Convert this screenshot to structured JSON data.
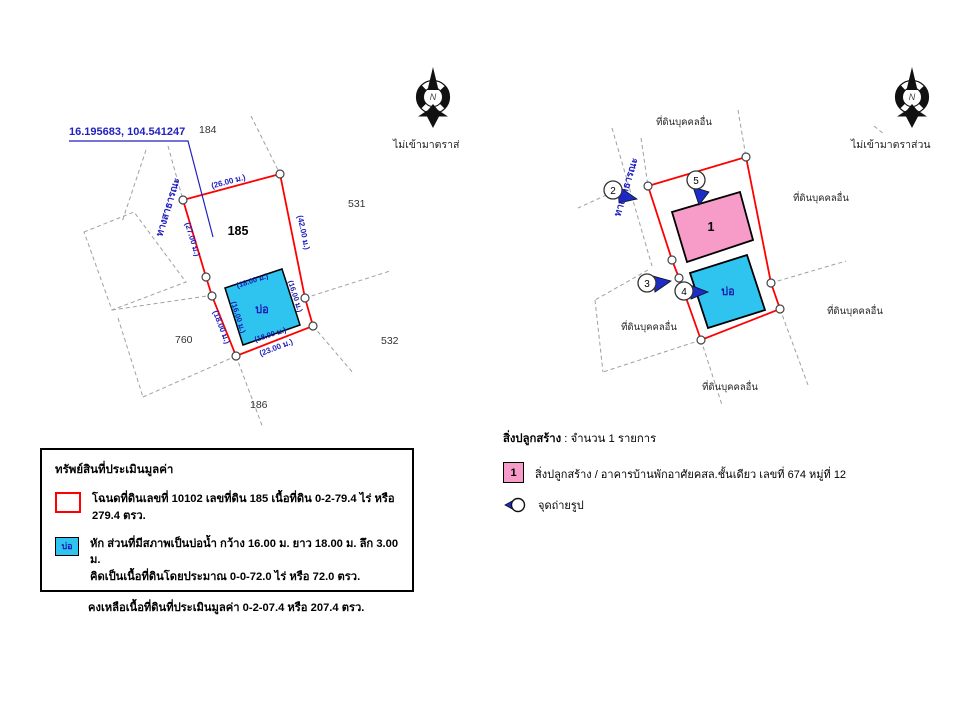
{
  "colors": {
    "boundary_red": "#ff0000",
    "label_blue": "#2222c0",
    "pond_cyan": "#2ec4ef",
    "building_pink": "#f79bc8",
    "dash_gray": "#a0a0a0"
  },
  "left_diagram": {
    "coords": "16.195683, 104.541247",
    "plot_number": "185",
    "neighbors": {
      "top": "184",
      "right_upper": "531",
      "right_lower": "532",
      "left": "760",
      "bottom": "186"
    },
    "road": "ทางสาธารณะ",
    "north": "N",
    "not_to_scale": "ไม่เข้ามาตราส่",
    "dims": {
      "top": "(26.00 ม.)",
      "right": "(42.00 ม.)",
      "left_upper": "(27.00 ม.)",
      "left_lower": "(18.00 ม.)",
      "bottom": "(23.00 ม.)"
    },
    "pond": {
      "label": "บ่อ",
      "top": "(18.00 ม.)",
      "right": "(16.00 ม.)",
      "bottom": "(18.00 ม.)",
      "left": "(16.00 ม.)"
    }
  },
  "right_diagram": {
    "road": "ทางสาธารณะ",
    "north": "N",
    "not_to_scale": "ไม่เข้ามาตราส่วน",
    "neighbor": "ที่ดินบุคคลอื่น",
    "building_label": "1",
    "pond_label": "บ่อ",
    "markers": [
      "2",
      "3",
      "4",
      "5"
    ]
  },
  "property_legend": {
    "title": "ทรัพย์สินที่ประเมินมูลค่า",
    "deed_line": "โฉนดที่ดินเลขที่ 10102 เลขที่ดิน 185 เนื้อที่ดิน 0-2-79.4 ไร่ หรือ 279.4 ตรว.",
    "pond_swatch_label": "บ่อ",
    "pond_line1": "หัก ส่วนที่มีสภาพเป็นบ่อน้ำ กว้าง 16.00 ม. ยาว 18.00 ม. ลึก 3.00 ม.",
    "pond_line2": "คิดเป็นเนื้อที่ดินโดยประมาณ 0-0-72.0 ไร่ หรือ 72.0 ตรว.",
    "remaining_line": "คงเหลือเนื้อที่ดินที่ประเมินมูลค่า 0-2-07.4 หรือ 207.4 ตรว."
  },
  "building_legend": {
    "header_label": "สิ่งปลูกสร้าง",
    "header_value": " : จำนวน 1 รายการ",
    "item_number": "1",
    "item_text": "สิ่งปลูกสร้าง / อาคารบ้านพักอาศัยคสล.ชั้นเดียว เลขที่ 674 หมู่ที่ 12",
    "photo_label": "จุดถ่ายรูป"
  }
}
